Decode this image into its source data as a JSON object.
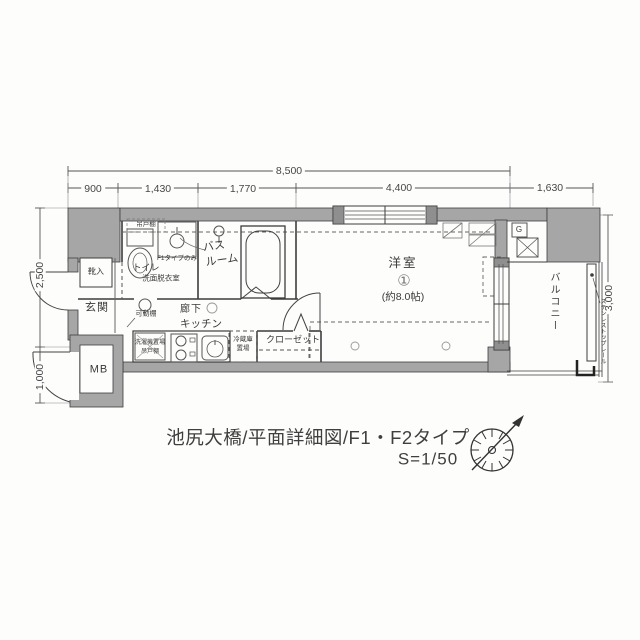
{
  "plan": {
    "rooms": {
      "entrance": "玄関",
      "shoe_box": "靴入",
      "toilet": "トイレ",
      "washroom": "洗面脱衣室",
      "bath_line1": "バス",
      "bath_line2": "ルーム",
      "hallway": "廊下",
      "kitchen": "キッチン",
      "living": "洋室",
      "living_size": "(約8.0帖)",
      "living_mark": "①",
      "closet": "クローゼット",
      "balcony": "バルコニー",
      "meter_box": "MB"
    },
    "annotations": {
      "hanging_shelf": "吊戸棚",
      "f1_note": "F1タイプのみ",
      "movable_shelf": "可動棚",
      "washer": "洗濯機置場",
      "washer_shelf": "吊戸棚",
      "fridge_line1": "冷蔵庫",
      "fridge_line2": "置場",
      "gas_meter": "G",
      "rail_note": "ステンレストップレール"
    }
  },
  "dimensions": {
    "total_width": "8,500",
    "seg1": "900",
    "seg2": "1,430",
    "seg3": "1,770",
    "seg4": "4,400",
    "seg5": "1,630",
    "left_upper": "2,500",
    "left_lower": "1,000",
    "right_side": "3,000"
  },
  "title_block": {
    "line1": "池尻大橋/平面詳細図/F1・F2タイプ",
    "scale": "S=1/50"
  },
  "colors": {
    "wall_fill": "#a6a6a6",
    "line": "#3d3d3d",
    "dim_text": "#474747"
  }
}
